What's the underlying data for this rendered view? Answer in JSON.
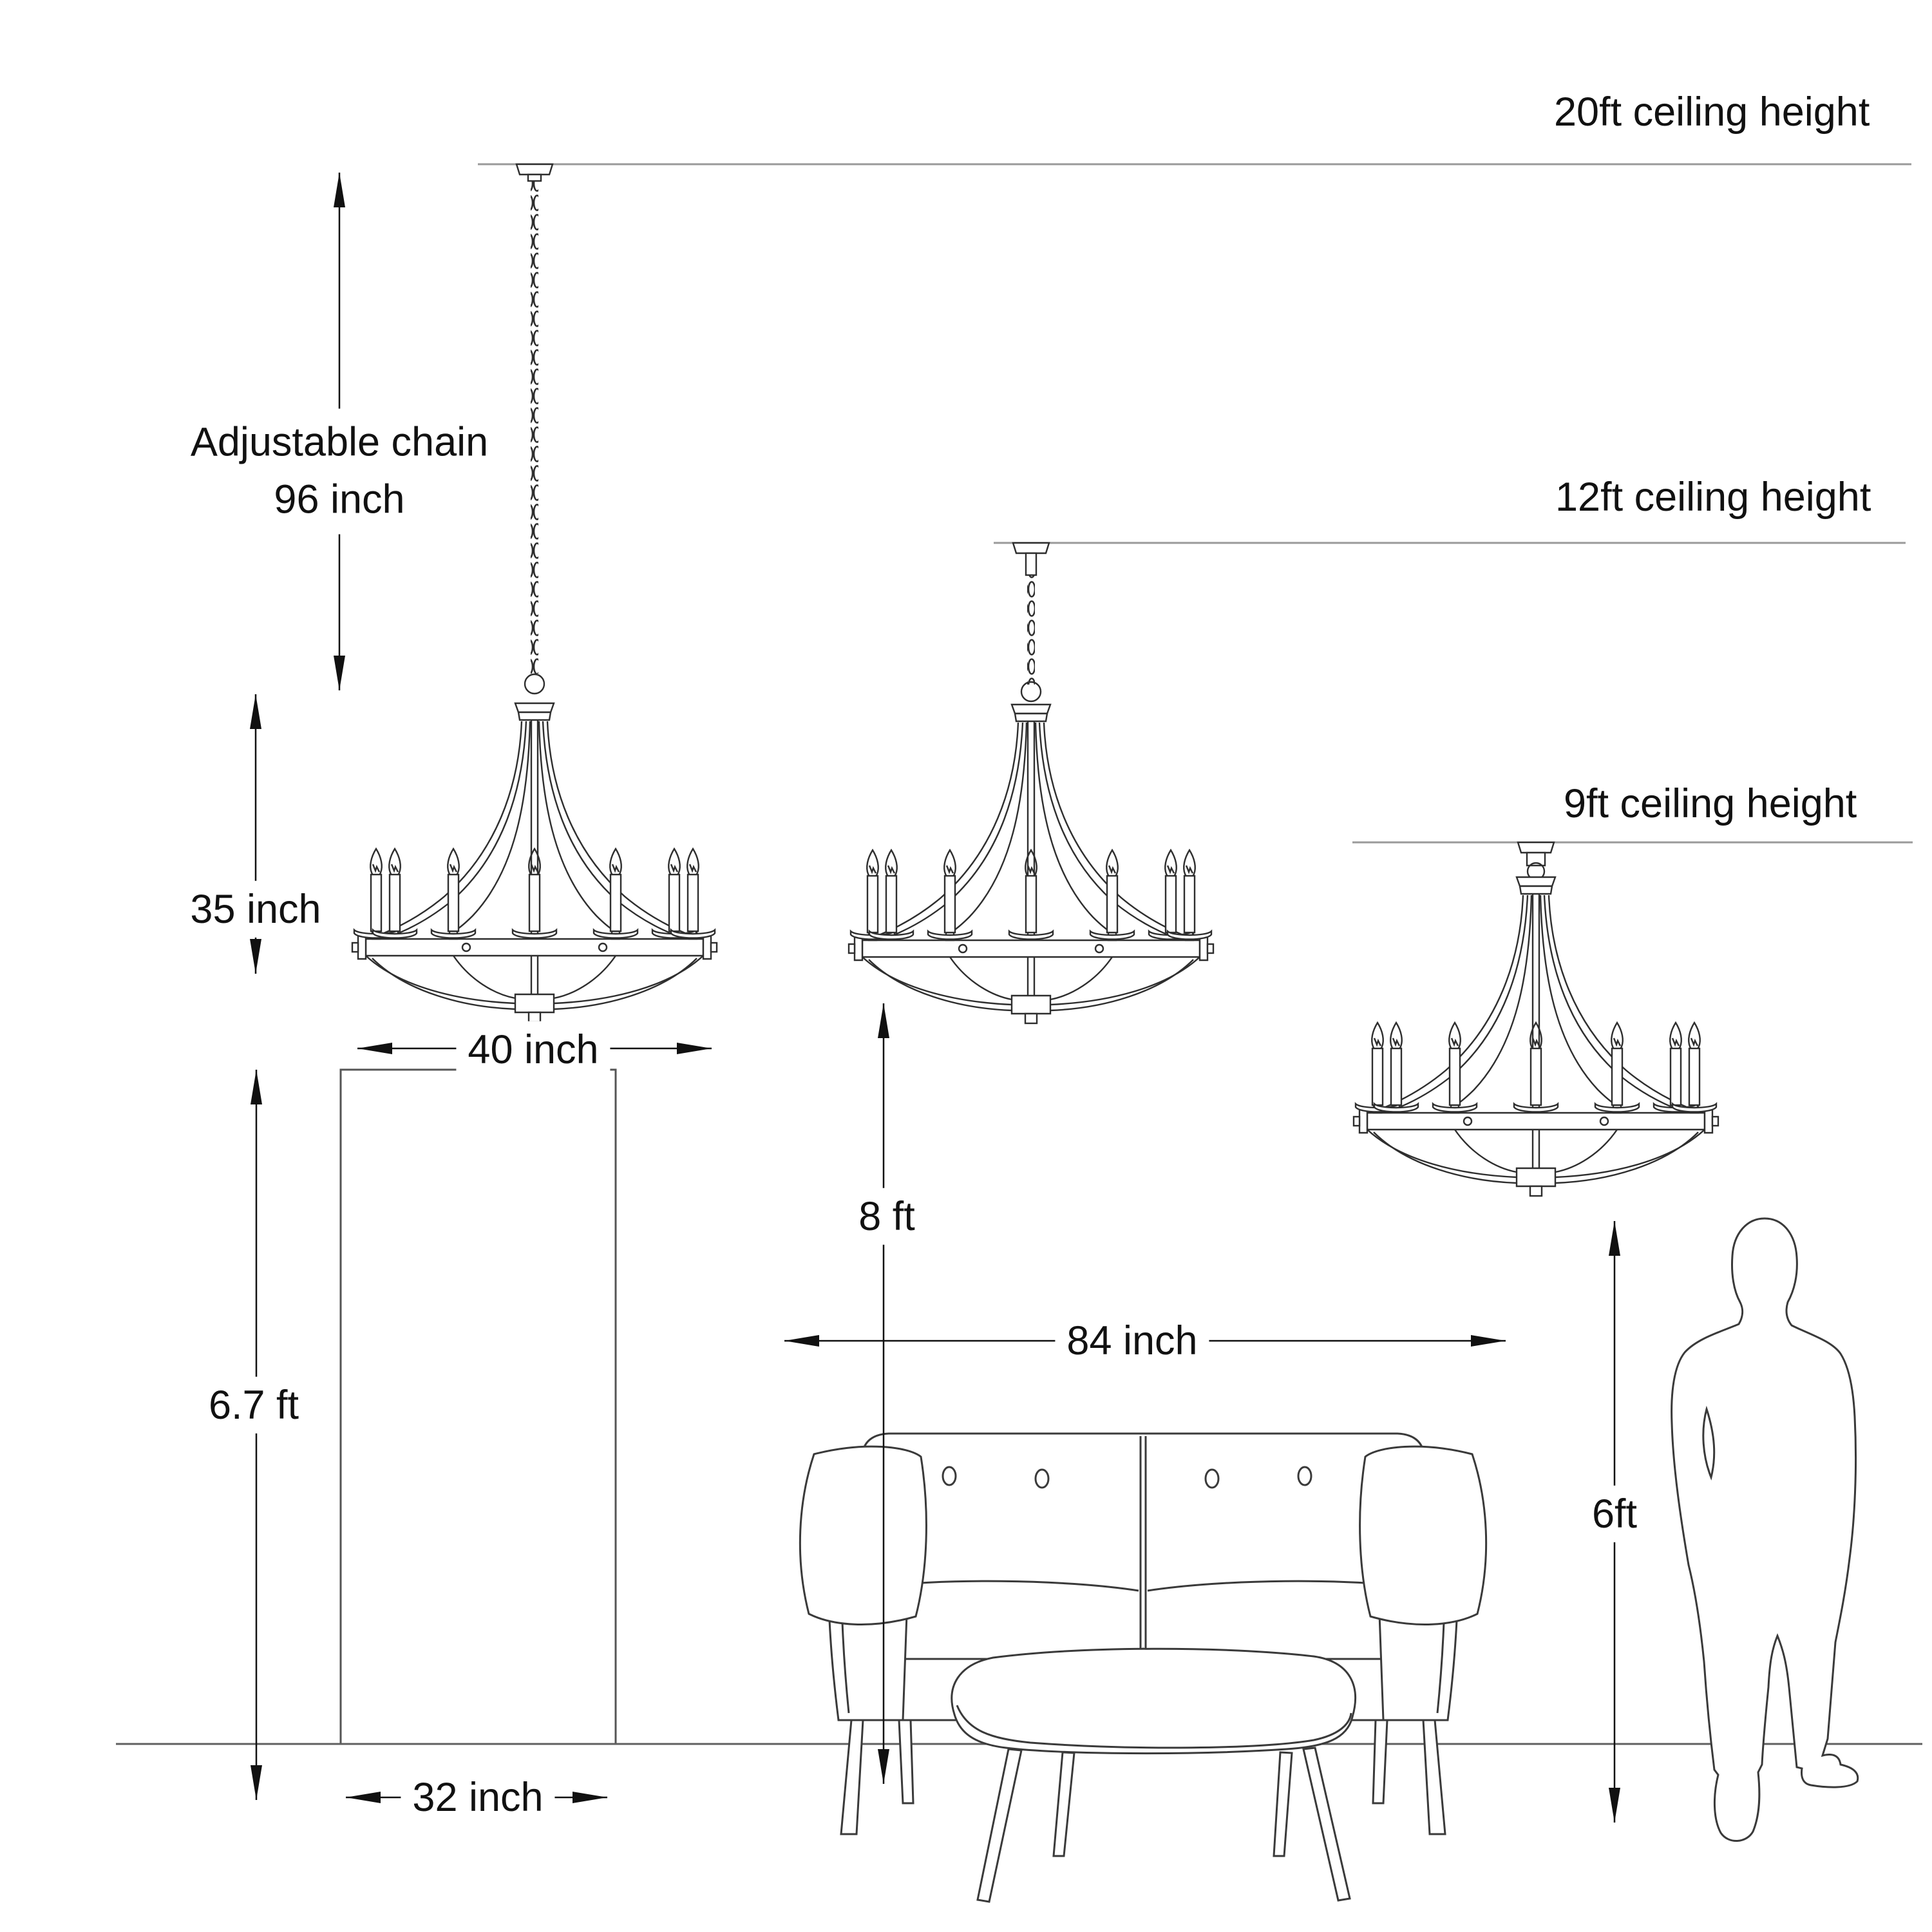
{
  "labels": {
    "ceiling_20ft": "20ft ceiling height",
    "ceiling_12ft": "12ft ceiling height",
    "ceiling_9ft": "9ft ceiling height",
    "chain_line1": "Adjustable chain",
    "chain_line2": "96 inch",
    "fixture_height": "35 inch",
    "fixture_width": "40 inch",
    "door_height": "6.7 ft",
    "door_width": "32 inch",
    "sofa_width": "84 inch",
    "floor_to_fixture": "8 ft",
    "person_height": "6ft"
  },
  "colors": {
    "background": "#ffffff",
    "line_art": "#2e2e2e",
    "furniture_line": "#3a3a3a",
    "ceiling_guide_line": "#9a9a9a",
    "floor_line": "#606060",
    "dimension_line": "#111111",
    "text": "#111111"
  }
}
